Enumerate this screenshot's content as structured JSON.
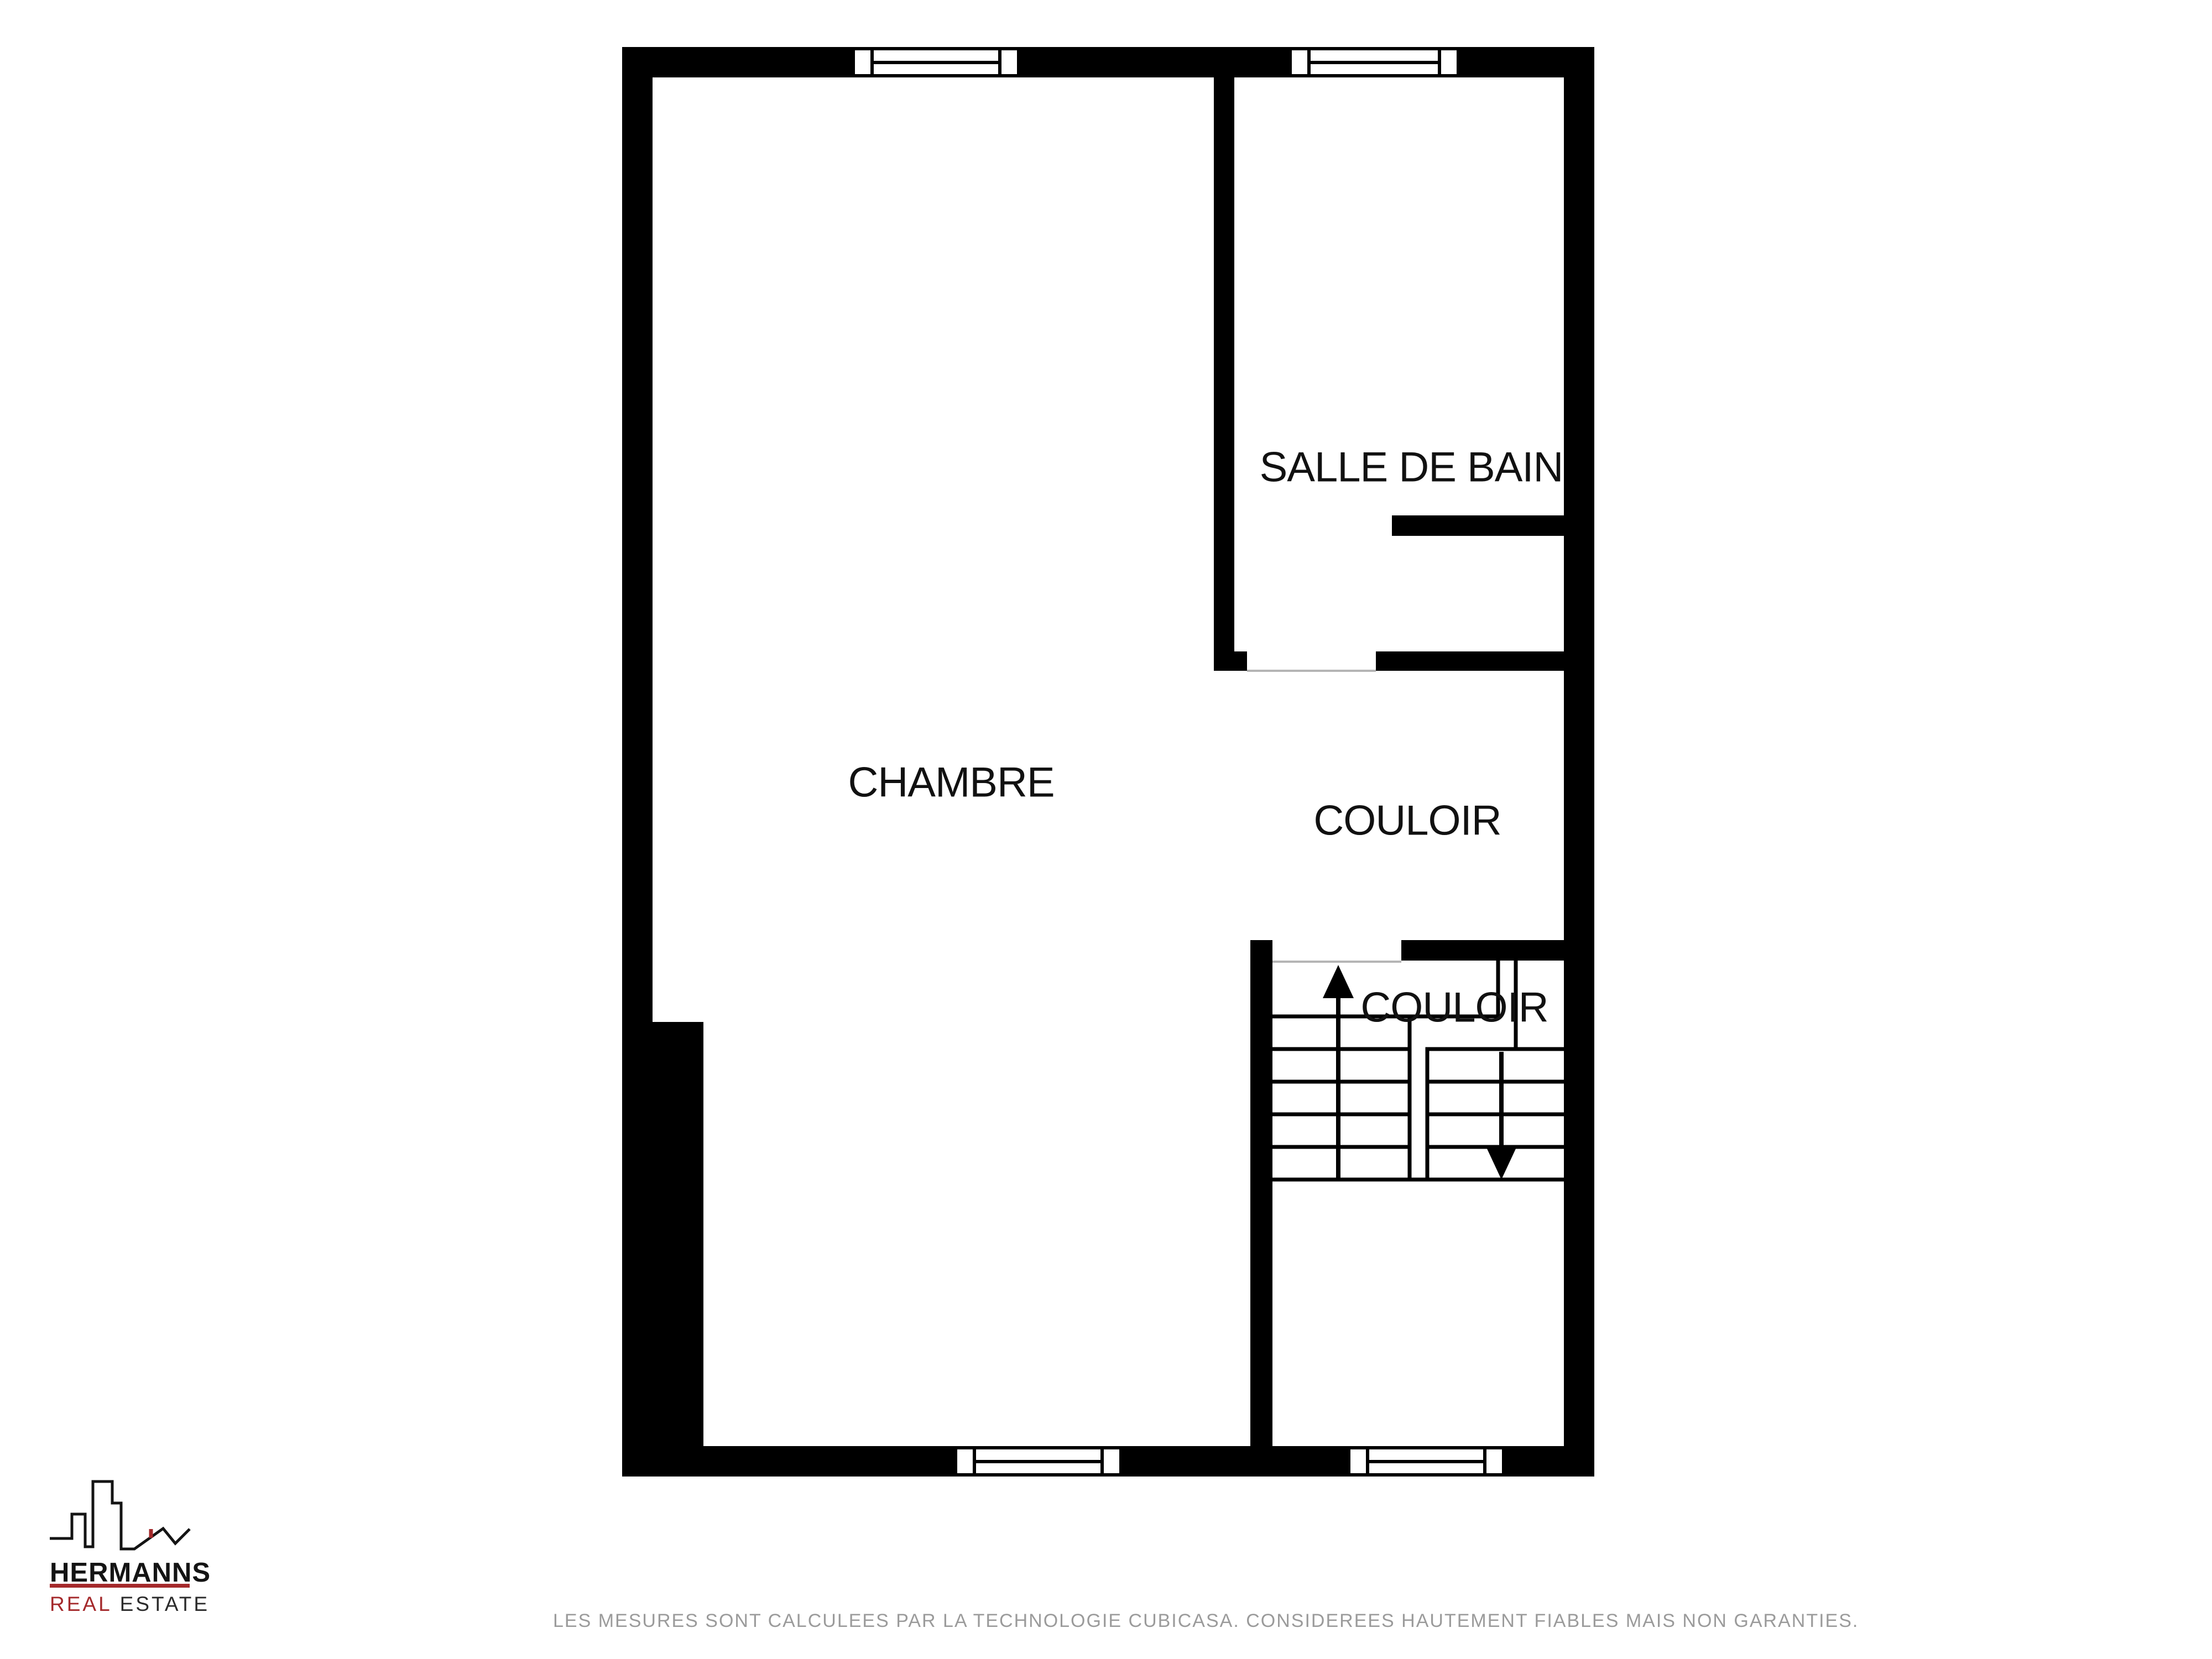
{
  "plan": {
    "type": "floor-plan",
    "wall_color": "#000000",
    "room_label_color": "#111111",
    "rooms": [
      {
        "id": "chambre",
        "label": "CHAMBRE"
      },
      {
        "id": "salle-de-bain",
        "label": "SALLE DE BAIN"
      },
      {
        "id": "couloir-upper",
        "label": "COULOIR"
      },
      {
        "id": "couloir-stairs",
        "label": "COULOIR"
      }
    ],
    "stairs": {
      "shape": "U-shaped",
      "up_icon": "arrow-up-icon",
      "down_icon": "arrow-down-icon"
    },
    "window_count": 4,
    "door_opening_count": 2
  },
  "logo": {
    "skyline_icon": "city-skyline-icon",
    "brand": "HERMANNS",
    "sub_red": "REAL",
    "sub_dark": "ESTATE",
    "accent_color": "#a4292b",
    "text_color": "#141414"
  },
  "footer": {
    "disclaimer": "LES MESURES SONT CALCULEES PAR LA TECHNOLOGIE CUBICASA. CONSIDEREES HAUTEMENT FIABLES MAIS NON GARANTIES.",
    "text_color": "#9b9b9b"
  }
}
